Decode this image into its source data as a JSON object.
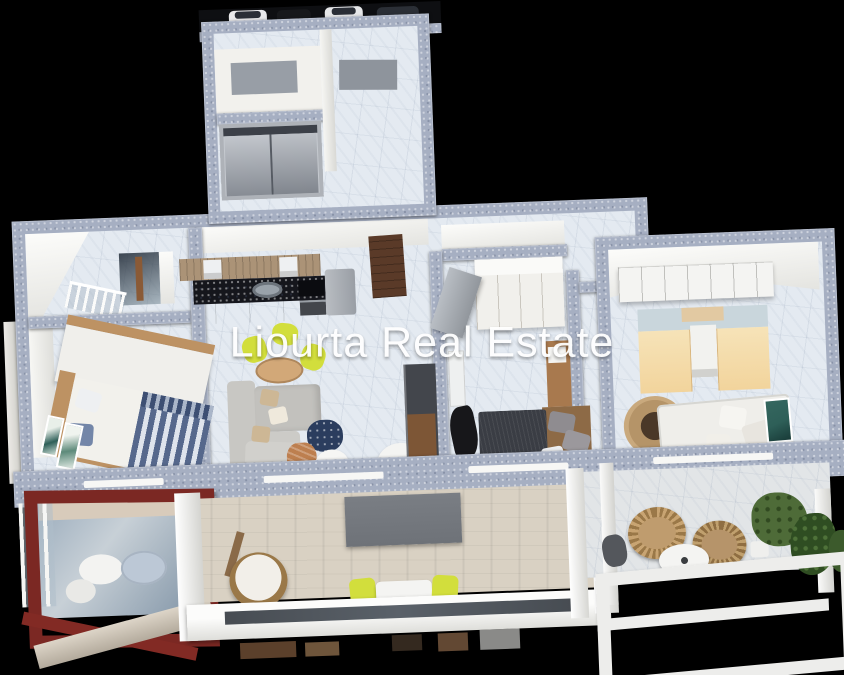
{
  "watermark": {
    "text": "Liourta Real Estate"
  },
  "palette": {
    "bg": "#000000",
    "wall_top": "#a6afc2",
    "wall_face": "#f1f1ee",
    "floor_tile": "#e4eaf1",
    "wood_floor": "#d9d1c3",
    "counter_dark": "#15161c",
    "cabinet_wood": "#ab9377",
    "fridge_grey": "#999ea5",
    "door_brown": "#5a3a28",
    "sofa_grey": "#c8c7c3",
    "lime_chair": "#d2de3c",
    "dining_wood": "#d2a878",
    "bed_stripe_blue": "#56688c",
    "headboard_wood": "#bd9263",
    "dark_bed": "#3a3d44",
    "kids_yellow": "#f2d49c",
    "rug_tan": "#c9a97d",
    "rug_center": "#4a3828",
    "red_frame": "#7b2823",
    "awning_grey": "#6e7278",
    "rattan": "#9a7848",
    "plant_green": "#4e6b38",
    "plant_dark": "#2f4d22",
    "teal_art": "#2e5f58",
    "glass_dark": "#474c52",
    "watermark": "#ffffff"
  }
}
